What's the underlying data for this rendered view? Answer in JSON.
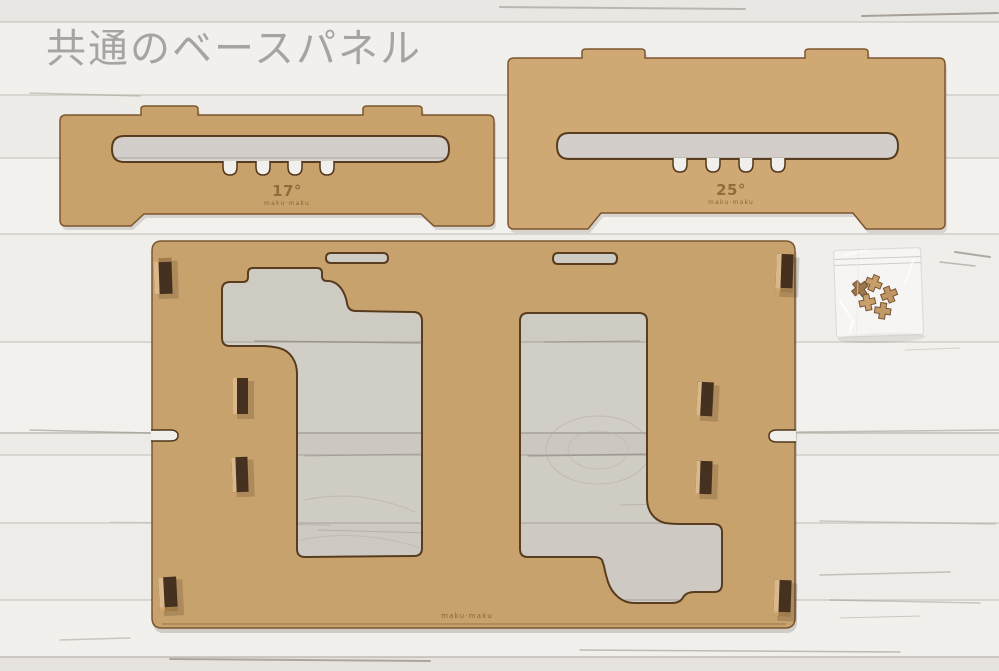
{
  "photo": {
    "title_overlay": "共通のベースパネル",
    "objects": {
      "angle_panel_17": {
        "angle_label": "17°",
        "brand_mark": "maku·maku"
      },
      "angle_panel_25": {
        "angle_label": "25°",
        "brand_mark": "maku·maku"
      },
      "base_panel": {
        "brand_mark": "maku·maku"
      },
      "parts_bag": {
        "piece_count": 5
      }
    },
    "colors": {
      "background": "#f0eeeb",
      "plank_line": "#c9c5be",
      "panel_17": "#c9a26b",
      "panel_25": "#cfa873",
      "base_panel": "#c8a26d",
      "cut_edge": "#503519",
      "outer_edge": "#7c5630",
      "tab_dark": "#46301f",
      "tab_light": "#d9b98b",
      "engraving": "#8b6638",
      "title": "#a09e9d"
    }
  }
}
